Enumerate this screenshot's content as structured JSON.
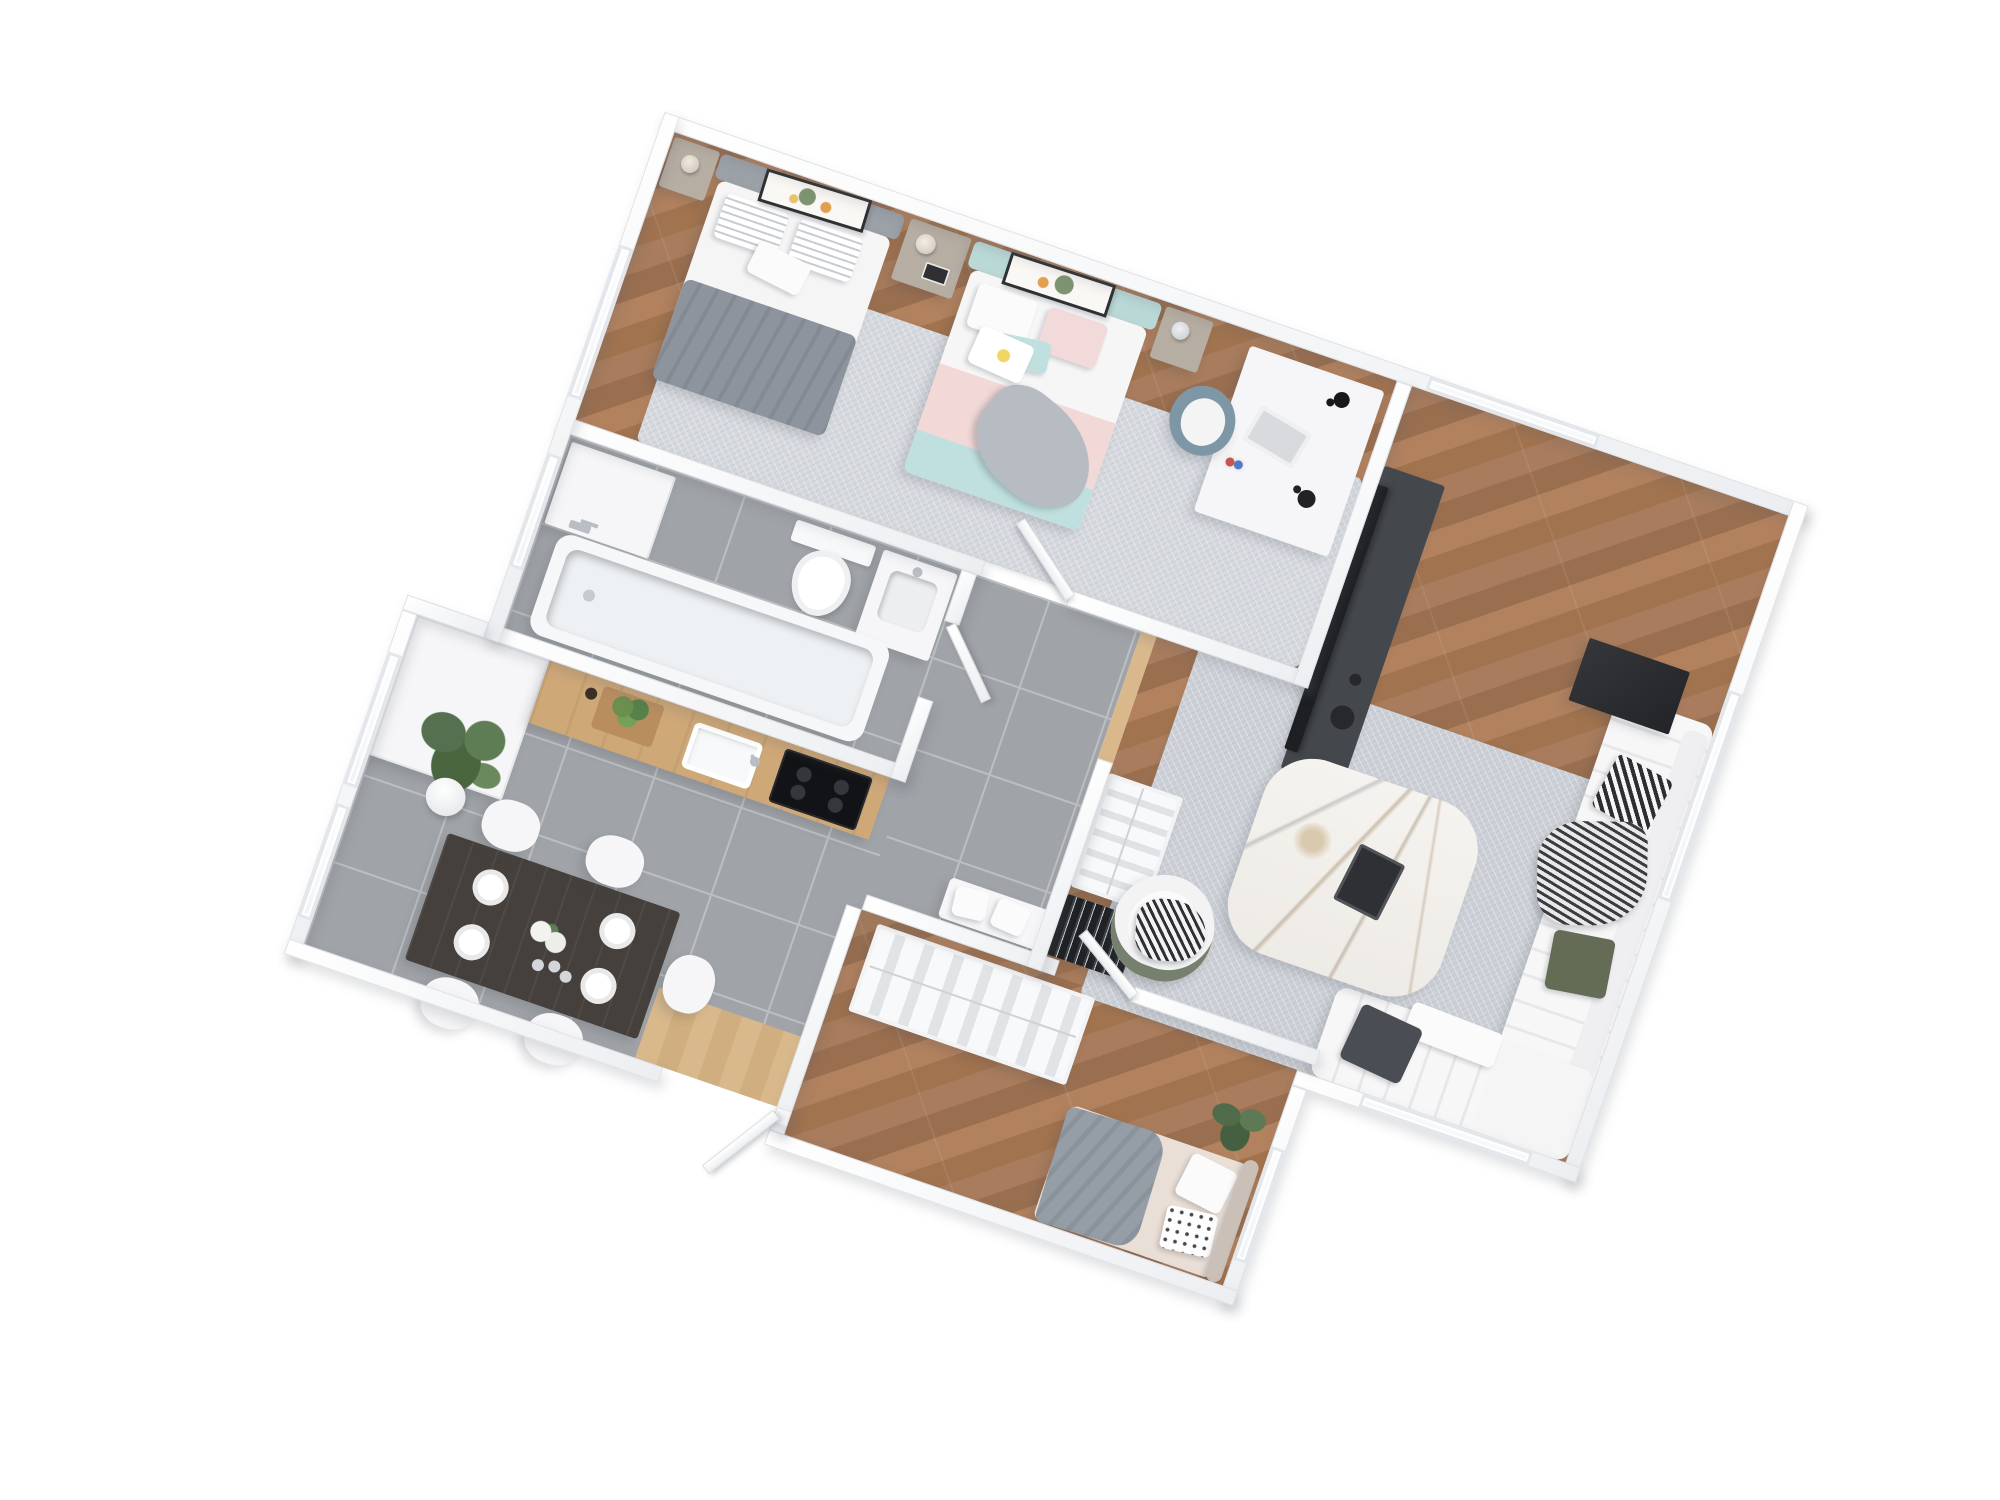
{
  "scene": {
    "type": "3d-floor-plan-render",
    "view": "top-down isometric apartment visualization",
    "background": "#ffffff",
    "rotation_deg": 19,
    "visible_text": "none"
  },
  "palette": {
    "wall": "#eceef1",
    "wallEdge": "#dfe1e6",
    "woodA": "#a87c5c",
    "woodB": "#9a6f50",
    "woodC": "#b2825f",
    "woodD": "#a1734f",
    "tile": "#a0a4a8",
    "tileLine": "#bcbfc2",
    "rug": "#d6d9de",
    "rugLiving": "#cdd1d7",
    "matA": "#d9b98c",
    "matB": "#d0ae7f",
    "counterWood": "#cfa878",
    "furnWhite": "#f6f6f8",
    "darkUnit": "#44484d",
    "black": "#1d1f22",
    "marble": "#f4f2ee",
    "headboardBlue": "#b9d8d6",
    "blanketPink": "#f2d9d8",
    "blanketTeal": "#bfe0de",
    "blanketGray": "#8d949d",
    "chairBlue": "#7d97a7",
    "plantGreen": "#57714f",
    "olive": "#646c55",
    "taupe": "#b7aea3",
    "bedBeige": "#eadfd6",
    "tableDark": "#46403c"
  },
  "rooms": [
    {
      "name": "bedroom-primary",
      "floor": "wood",
      "items": [
        "bed-gray",
        "bed-pastel",
        "nightstand-left",
        "nightstand-middle",
        "nightstand-right",
        "table-lamps",
        "wall-art-botanical-1",
        "wall-art-botanical-2",
        "area-rug-light",
        "desk",
        "laptop",
        "desk-lamps",
        "desk-chair-blue"
      ]
    },
    {
      "name": "living-room",
      "floor": "wood",
      "items": [
        "sectional-sofa-white",
        "cushion-checker",
        "cushion-olive",
        "cushion-gray",
        "throw-zigzag",
        "side-table-black",
        "coffee-table-marble",
        "book",
        "armchair-white",
        "armchair-throw-striped",
        "area-rug-gray",
        "tv-black",
        "media-console-dark",
        "open-wardrobe-garment-bags",
        "console-binders-black",
        "floor-lamp-glass-globe"
      ]
    },
    {
      "name": "bathroom",
      "floor": "tile",
      "items": [
        "bathtub",
        "shower-fixture",
        "wall-hung-toilet",
        "vanity-sink",
        "storage-cabinet"
      ]
    },
    {
      "name": "kitchen",
      "floor": "tile",
      "items": [
        "wood-countertop",
        "sink",
        "faucet",
        "induction-cooktop",
        "herb-planter",
        "tall-cabinets"
      ]
    },
    {
      "name": "dining-area",
      "floor": "tile",
      "items": [
        "dining-table-dark",
        "plates-x4",
        "flower-centerpiece",
        "glasses",
        "chairs-white-x5",
        "palm-plant"
      ]
    },
    {
      "name": "bedroom-second",
      "floor": "wood",
      "items": [
        "bed-beige",
        "blanket-gray",
        "pillow-polkadot",
        "headboard",
        "open-wardrobe-garment-bags",
        "monstera-plant"
      ]
    },
    {
      "name": "hallway-entry",
      "floor": "tile",
      "items": [
        "bench-white-pillows",
        "entry-door-mat-wood",
        "threshold-wood-strip"
      ]
    }
  ],
  "openings": {
    "windows": [
      "top-wall-living",
      "right-wall-living",
      "bottom-wall-living",
      "right-wall-bedroom-second",
      "left-wall-bedroom-primary",
      "left-wall-bathroom",
      "left-wall-dining-1",
      "left-wall-dining-2"
    ],
    "doors": [
      "entry-door",
      "bedroom-primary-door",
      "bathroom-door",
      "bedroom-second-door"
    ]
  }
}
